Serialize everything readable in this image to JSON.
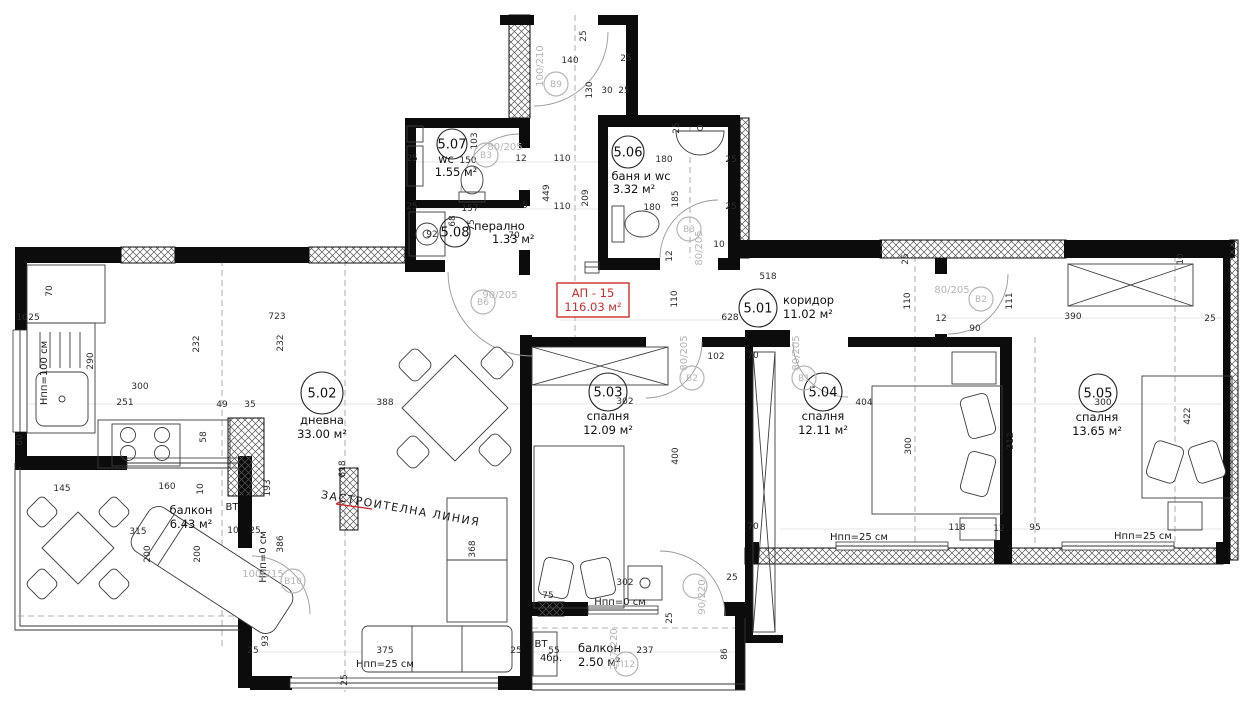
{
  "apartment": {
    "id": "АП - 15",
    "area": "116.03 м²"
  },
  "colors": {
    "accent_red": "#cf2b2b",
    "wall": "#0c0c0c",
    "marker_gray": "#b5b5b5"
  },
  "rooms": [
    {
      "num": "5.01",
      "name": "коридор",
      "area": "11.02 м²",
      "cx": 758,
      "cy": 308,
      "r": 19,
      "lx": 783,
      "ly": 304,
      "ax": 783,
      "ay": 318,
      "anchor": "start"
    },
    {
      "num": "5.02",
      "name": "дневна",
      "area": "33.00 м²",
      "cx": 322,
      "cy": 393,
      "r": 21,
      "lx": 322,
      "ly": 424,
      "ax": 322,
      "ay": 438,
      "anchor": "middle"
    },
    {
      "num": "5.03",
      "name": "спалня",
      "area": "12.09 м²",
      "cx": 608,
      "cy": 392,
      "r": 19,
      "lx": 608,
      "ly": 420,
      "ax": 608,
      "ay": 434,
      "anchor": "middle"
    },
    {
      "num": "5.04",
      "name": "спалня",
      "area": "12.11 м²",
      "cx": 823,
      "cy": 392,
      "r": 19,
      "lx": 823,
      "ly": 420,
      "ax": 823,
      "ay": 434,
      "anchor": "middle"
    },
    {
      "num": "5.05",
      "name": "спалня",
      "area": "13.65 м²",
      "cx": 1098,
      "cy": 393,
      "r": 19,
      "lx": 1097,
      "ly": 421,
      "ax": 1097,
      "ay": 435,
      "anchor": "middle"
    },
    {
      "num": "5.06",
      "name": "баня и wc",
      "area": "3.32 м²",
      "cx": 628,
      "cy": 152,
      "r": 16,
      "lx": 641,
      "ly": 180,
      "ax": 634,
      "ay": 193,
      "anchor": "middle"
    },
    {
      "num": "5.07",
      "name": "wc",
      "area": "1.55 м²",
      "cx": 452,
      "cy": 144,
      "r": 15,
      "lx": 446,
      "ly": 163,
      "ax": 456,
      "ay": 176,
      "anchor": "middle"
    },
    {
      "num": "5.08",
      "name": "перално",
      "area": "1.33 м²",
      "cx": 455,
      "cy": 232,
      "r": 15,
      "lx": 474,
      "ly": 230,
      "ax": 492,
      "ay": 243,
      "anchor": "start"
    },
    {
      "num": "",
      "name": "балкон",
      "area": "6.43 м²",
      "lx": 191,
      "ly": 514,
      "ax": 191,
      "ay": 528,
      "anchor": "middle"
    },
    {
      "num": "",
      "name": "балкон",
      "area": "2.50 м²",
      "lx": 578,
      "ly": 652,
      "ax": 578,
      "ay": 666,
      "anchor": "start"
    }
  ],
  "door_markers": [
    {
      "id": "B9",
      "size": "100/210",
      "x": 556,
      "y": 84,
      "sx": 543,
      "sy": 66,
      "sr": -90
    },
    {
      "id": "B3",
      "size": "80/205",
      "x": 486,
      "y": 155,
      "sx": 505,
      "sy": 150,
      "sr": 0
    },
    {
      "id": "B3",
      "size": "80/205",
      "x": 689,
      "y": 229,
      "sx": 702,
      "sy": 248,
      "sr": -90
    },
    {
      "id": "B6",
      "size": "90/205",
      "x": 483,
      "y": 302,
      "sx": 500,
      "sy": 298,
      "sr": 0
    },
    {
      "id": "B2",
      "size": "80/205",
      "x": 692,
      "y": 378,
      "sx": 687,
      "sy": 353,
      "sr": -90
    },
    {
      "id": "B1",
      "size": "80/205",
      "x": 804,
      "y": 378,
      "sx": 799,
      "sy": 353,
      "sr": -90
    },
    {
      "id": "B2",
      "size": "80/205",
      "x": 981,
      "y": 299,
      "sx": 952,
      "sy": 293,
      "sr": 0
    },
    {
      "id": "B10",
      "size": "100/215",
      "x": 293,
      "y": 581,
      "sx": 263,
      "sy": 577,
      "sr": 0
    },
    {
      "id": "П12",
      "size": "227/220",
      "x": 626,
      "y": 664,
      "sx": 617,
      "sy": 649,
      "sr": -90
    },
    {
      "id": "",
      "size": "90/220",
      "x": 695,
      "y": 586,
      "sx": 705,
      "sy": 597,
      "sr": -90
    }
  ],
  "annotations": [
    {
      "t": "Нпп=100 см",
      "x": 47,
      "y": 373,
      "r": -90
    },
    {
      "t": "Нпп=0 см",
      "x": 266,
      "y": 557,
      "r": -90
    },
    {
      "t": "Нпп=0 см",
      "x": 620,
      "y": 605,
      "r": 0
    },
    {
      "t": "Нпп=25 см",
      "x": 385,
      "y": 667,
      "r": 0
    },
    {
      "t": "Нпп=25 см",
      "x": 859,
      "y": 540,
      "r": 0
    },
    {
      "t": "Нпп=25 см",
      "x": 1143,
      "y": 539,
      "r": 0
    },
    {
      "t": "ЗАСТРОИТЕЛНА ЛИНИЯ",
      "x": 400,
      "y": 512,
      "r": 10,
      "cls": "big"
    },
    {
      "t": "ВТ",
      "x": 232,
      "y": 510,
      "r": 0
    },
    {
      "t": "ВТ",
      "x": 541,
      "y": 647,
      "r": 0
    },
    {
      "t": "4бр.",
      "x": 551,
      "y": 661,
      "r": 0
    }
  ],
  "dimensions": [
    {
      "t": "518",
      "x": 768,
      "y": 279
    },
    {
      "t": "628",
      "x": 730,
      "y": 320
    },
    {
      "t": "110",
      "x": 677,
      "y": 299,
      "r": -90
    },
    {
      "t": "140",
      "x": 570,
      "y": 63
    },
    {
      "t": "130",
      "x": 592,
      "y": 90,
      "r": -90
    },
    {
      "t": "30",
      "x": 607,
      "y": 93
    },
    {
      "t": "25",
      "x": 626,
      "y": 61
    },
    {
      "t": "25",
      "x": 586,
      "y": 36,
      "r": -90
    },
    {
      "t": "25",
      "x": 624,
      "y": 93
    },
    {
      "t": "25",
      "x": 412,
      "y": 161
    },
    {
      "t": "103",
      "x": 477,
      "y": 141,
      "r": -90
    },
    {
      "t": "150",
      "x": 468,
      "y": 163
    },
    {
      "t": "12",
      "x": 521,
      "y": 161
    },
    {
      "t": "110",
      "x": 562,
      "y": 161
    },
    {
      "t": "449",
      "x": 549,
      "y": 193,
      "r": -90
    },
    {
      "t": "209",
      "x": 588,
      "y": 198,
      "r": -90
    },
    {
      "t": "110",
      "x": 562,
      "y": 209
    },
    {
      "t": "25",
      "x": 412,
      "y": 209
    },
    {
      "t": "157",
      "x": 470,
      "y": 211
    },
    {
      "t": "5",
      "x": 525,
      "y": 208
    },
    {
      "t": "68",
      "x": 455,
      "y": 221,
      "r": -90
    },
    {
      "t": "75",
      "x": 474,
      "y": 225,
      "r": -90
    },
    {
      "t": "92",
      "x": 432,
      "y": 237
    },
    {
      "t": "70",
      "x": 514,
      "y": 238
    },
    {
      "t": "25",
      "x": 679,
      "y": 128,
      "r": -90
    },
    {
      "t": "180",
      "x": 664,
      "y": 162
    },
    {
      "t": "25",
      "x": 731,
      "y": 162
    },
    {
      "t": "185",
      "x": 678,
      "y": 199,
      "r": -90
    },
    {
      "t": "180",
      "x": 652,
      "y": 210
    },
    {
      "t": "25",
      "x": 731,
      "y": 209
    },
    {
      "t": "10",
      "x": 719,
      "y": 247
    },
    {
      "t": "12",
      "x": 672,
      "y": 256,
      "r": -90
    },
    {
      "t": "723",
      "x": 277,
      "y": 319
    },
    {
      "t": "232",
      "x": 199,
      "y": 344,
      "r": -90
    },
    {
      "t": "232",
      "x": 283,
      "y": 343,
      "r": -90
    },
    {
      "t": "300",
      "x": 140,
      "y": 389
    },
    {
      "t": "251",
      "x": 125,
      "y": 405
    },
    {
      "t": "49",
      "x": 222,
      "y": 407
    },
    {
      "t": "35",
      "x": 250,
      "y": 407
    },
    {
      "t": "290",
      "x": 93,
      "y": 361,
      "r": -90
    },
    {
      "t": "70",
      "x": 52,
      "y": 291,
      "r": -90
    },
    {
      "t": "10",
      "x": 22,
      "y": 320
    },
    {
      "t": "25",
      "x": 34,
      "y": 320
    },
    {
      "t": "60",
      "x": 22,
      "y": 440,
      "r": -90
    },
    {
      "t": "58",
      "x": 206,
      "y": 437,
      "r": -90
    },
    {
      "t": "145",
      "x": 62,
      "y": 491
    },
    {
      "t": "388",
      "x": 385,
      "y": 405
    },
    {
      "t": "618",
      "x": 345,
      "y": 469,
      "r": -90
    },
    {
      "t": "160",
      "x": 167,
      "y": 489
    },
    {
      "t": "10",
      "x": 203,
      "y": 489,
      "r": -90
    },
    {
      "t": "315",
      "x": 138,
      "y": 534
    },
    {
      "t": "200",
      "x": 150,
      "y": 554,
      "r": -90
    },
    {
      "t": "200",
      "x": 200,
      "y": 554,
      "r": -90
    },
    {
      "t": "10",
      "x": 233,
      "y": 533
    },
    {
      "t": "25",
      "x": 255,
      "y": 533
    },
    {
      "t": "193",
      "x": 270,
      "y": 488,
      "r": -90
    },
    {
      "t": "386",
      "x": 283,
      "y": 544,
      "r": -90
    },
    {
      "t": "93",
      "x": 268,
      "y": 641,
      "r": -90
    },
    {
      "t": "25",
      "x": 253,
      "y": 653
    },
    {
      "t": "375",
      "x": 385,
      "y": 653
    },
    {
      "t": "25",
      "x": 347,
      "y": 680,
      "r": -90
    },
    {
      "t": "25",
      "x": 516,
      "y": 653
    },
    {
      "t": "302",
      "x": 625,
      "y": 404
    },
    {
      "t": "400",
      "x": 678,
      "y": 456,
      "r": -90
    },
    {
      "t": "302",
      "x": 625,
      "y": 585
    },
    {
      "t": "75",
      "x": 548,
      "y": 598
    },
    {
      "t": "70",
      "x": 753,
      "y": 358
    },
    {
      "t": "102",
      "x": 716,
      "y": 359
    },
    {
      "t": "70",
      "x": 753,
      "y": 529
    },
    {
      "t": "404",
      "x": 864,
      "y": 405
    },
    {
      "t": "300",
      "x": 911,
      "y": 446,
      "r": -90
    },
    {
      "t": "118",
      "x": 957,
      "y": 530
    },
    {
      "t": "12",
      "x": 999,
      "y": 531
    },
    {
      "t": "95",
      "x": 1035,
      "y": 530
    },
    {
      "t": "300",
      "x": 1103,
      "y": 405
    },
    {
      "t": "312",
      "x": 1013,
      "y": 441,
      "r": -90
    },
    {
      "t": "422",
      "x": 1190,
      "y": 416,
      "r": -90
    },
    {
      "t": "390",
      "x": 1073,
      "y": 319
    },
    {
      "t": "111",
      "x": 1012,
      "y": 301,
      "r": -90
    },
    {
      "t": "110",
      "x": 910,
      "y": 301,
      "r": -90
    },
    {
      "t": "90",
      "x": 975,
      "y": 331
    },
    {
      "t": "12",
      "x": 941,
      "y": 321
    },
    {
      "t": "25",
      "x": 1210,
      "y": 321
    },
    {
      "t": "25",
      "x": 908,
      "y": 259,
      "r": -90
    },
    {
      "t": "10",
      "x": 1183,
      "y": 259,
      "r": -90
    },
    {
      "t": "237",
      "x": 645,
      "y": 653
    },
    {
      "t": "86",
      "x": 727,
      "y": 654,
      "r": -90
    },
    {
      "t": "55",
      "x": 554,
      "y": 653
    },
    {
      "t": "25",
      "x": 732,
      "y": 580
    },
    {
      "t": "25",
      "x": 672,
      "y": 618,
      "r": -90
    },
    {
      "t": "368",
      "x": 475,
      "y": 549,
      "r": -90
    }
  ]
}
